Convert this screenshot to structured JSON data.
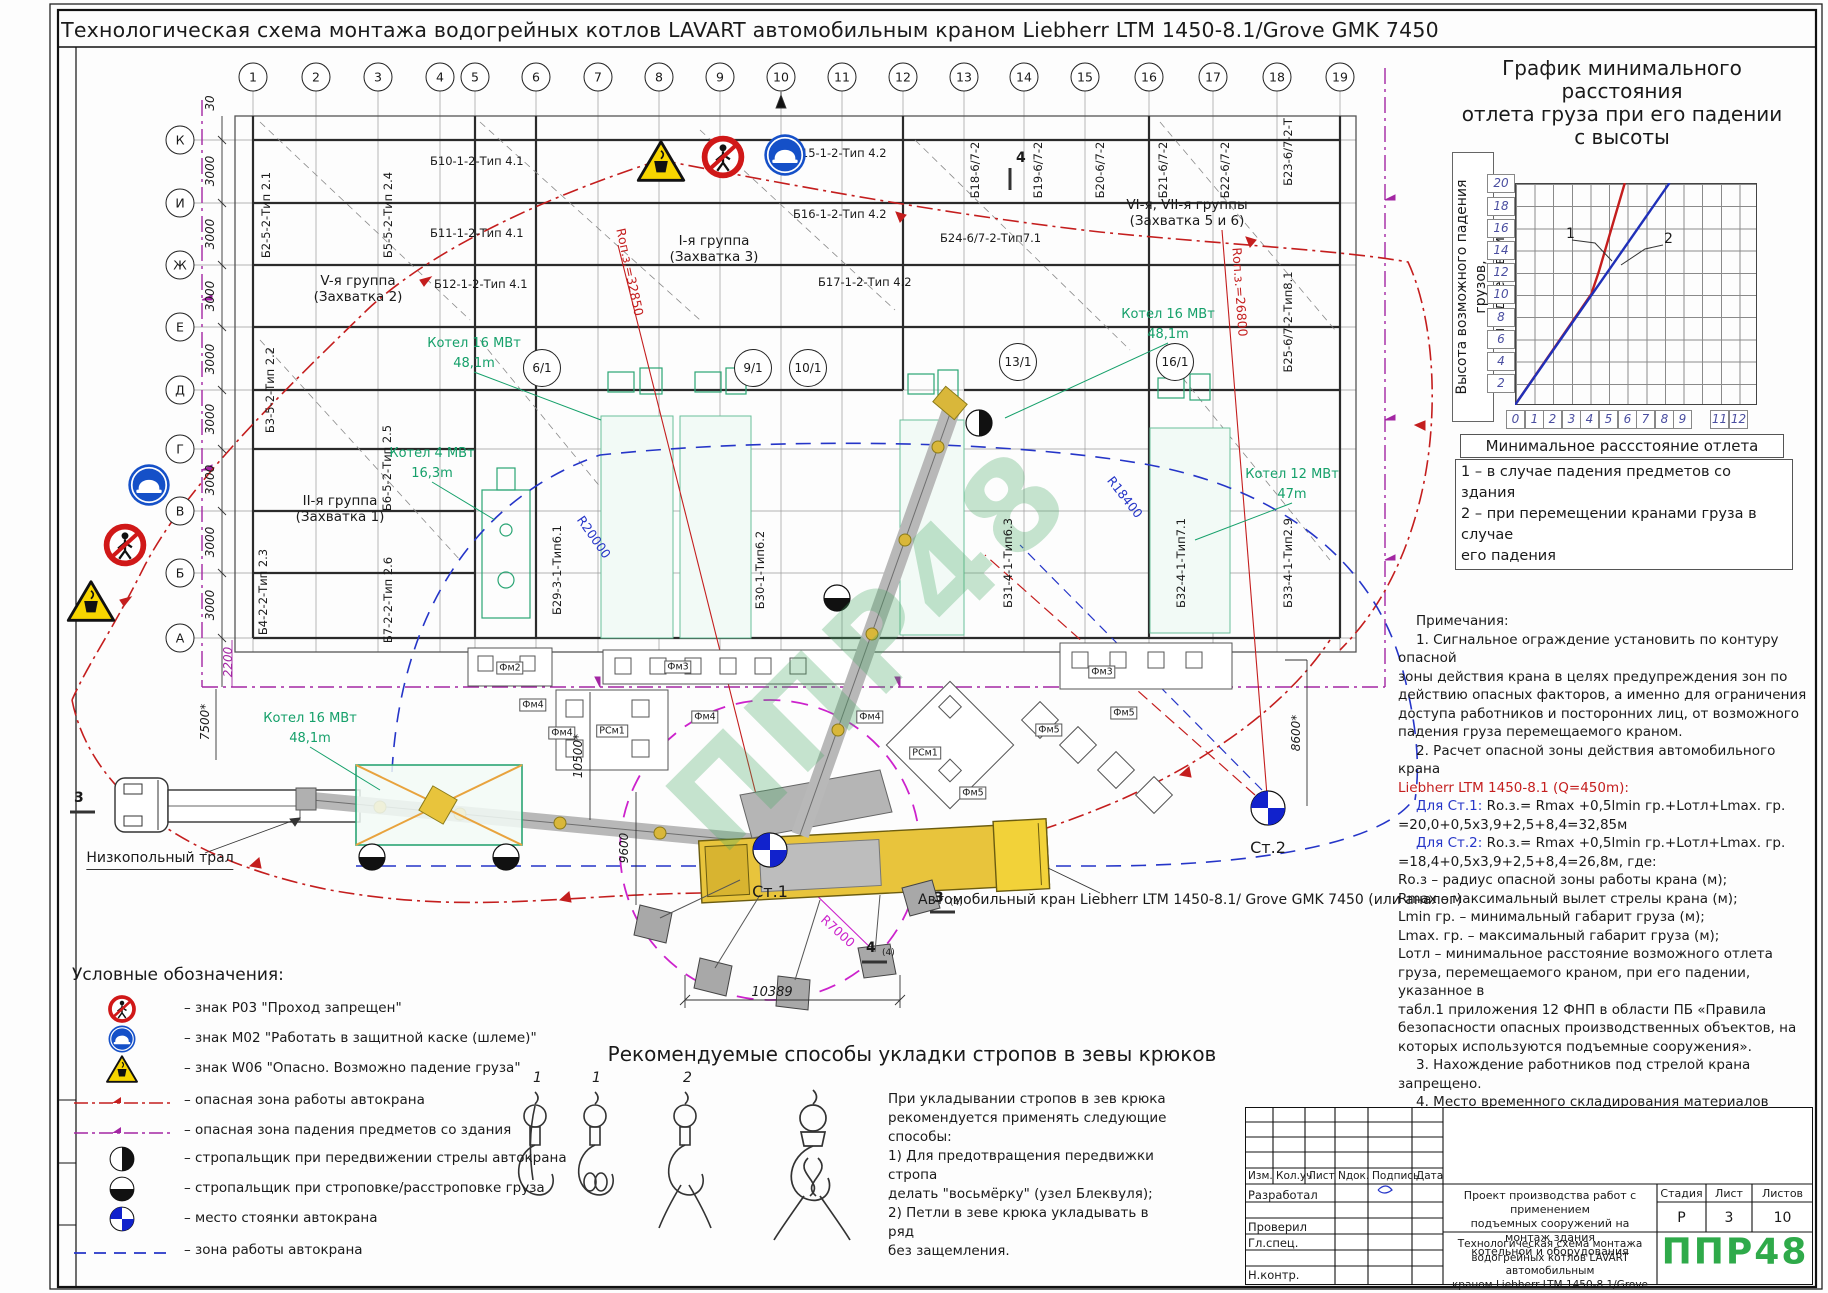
{
  "sheet": {
    "title": "Технологическая схема монтажа водогрейных котлов LAVART автомобильным краном Liebherr LTM 1450-8.1/Grove GMK 7450",
    "watermark": "ППР48"
  },
  "grid": {
    "cols": [
      "1",
      "2",
      "3",
      "4",
      "5",
      "6",
      "7",
      "8",
      "9",
      "10",
      "11",
      "12",
      "13",
      "14",
      "15",
      "16",
      "17",
      "18",
      "19"
    ],
    "rows": [
      "К",
      "И",
      "Ж",
      "Е",
      "Д",
      "Г",
      "В",
      "Б",
      "А"
    ],
    "dim3000": "3000",
    "dim30": "30"
  },
  "plan": {
    "beams": [
      "Б10-1-2-Тип 4.1",
      "Б11-1-2-Тип 4.1",
      "Б12-1-2-Тип 4.1",
      "Б15-1-2-Тип 4.2",
      "Б16-1-2-Тип 4.2",
      "Б17-1-2-Тип 4.2",
      "Б24-6/7-2-Тип7.1",
      "Б2-5-2-Тип 2.1",
      "Б5-5-2-Тип 2.4",
      "Б3-5-2-Тип 2.2",
      "Б6-5-2-Тип 2.5",
      "Б4-2-2-Тип 2.3",
      "Б7-2-2-Тип 2.6",
      "Б18-6/7-2",
      "Б19-6/7-2",
      "Б20-6/7-2",
      "Б21-6/7-2",
      "Б22-6/7-2",
      "Б23-6/7-2-Т",
      "Б25-6/7-2-Тип8.1",
      "Б29-3-1-Тип6.1",
      "Б30-1-Тип6.2",
      "Б31-4-1-Тип6.3",
      "Б32-4-1-Тип7.1",
      "Б33-4-1-Тип2.9"
    ],
    "groups": [
      "V-я группа\n(Захватка 2)",
      "I-я группа\n(Захватка 3)",
      "II-я группа\n(Захватка 1)",
      "VI-я, VII-я группы\n(Захватка 5 и 6)"
    ],
    "kotel": [
      "Котел 16 МВт\n48,1m",
      "Котел 4 МВт\n16,3m",
      "Котел 16 МВт\n48,1m",
      "Котел 12 МВт\n47m",
      "Котел 16 МВт\n48,1m"
    ],
    "radii": [
      "Rоп.з.=32850",
      "Rоп.з.=26800",
      "R20000",
      "R18400",
      "R7000"
    ],
    "sections": [
      "6/1",
      "9/1",
      "10/1",
      "13/1",
      "16/1"
    ],
    "stations": [
      "Ст.1",
      "Ст.2"
    ],
    "fm": [
      "Фм2",
      "Фм3",
      "Фм3",
      "Фм4",
      "Фм4",
      "Фм4",
      "Фм4",
      "Фм5",
      "Фм5",
      "Фм5",
      "РСм1",
      "РСм1"
    ],
    "dims": {
      "d2200": "2200",
      "d7500": "7500*",
      "d10500": "10500*",
      "d9600": "9600",
      "d8600": "8600*",
      "d10389": "10389"
    },
    "cuts": {
      "top": "4",
      "left": "3",
      "r1": "3",
      "r1s": "(4)",
      "r2": "4",
      "r2s": "(4)"
    }
  },
  "machines": {
    "truck": "Низкопольный\nтрал",
    "crane": "Автомобильный кран\nLiebherr LTM 1450-8.1/\nGrove GMK 7450 (или аналог)"
  },
  "chart_data": {
    "type": "line",
    "title": "График минимального\nрасстояния\nотлета груза при его падении\nс высоты",
    "ylabel": "Высота возможного падения грузов,\nпредметов, м",
    "xlabel": "Минимальное рассстояние отлета груза, м",
    "x_ticks": [
      "0",
      "1",
      "2",
      "3",
      "4",
      "5",
      "6",
      "7",
      "8",
      "9",
      "11",
      "12"
    ],
    "y_ticks": [
      "20",
      "18",
      "16",
      "14",
      "12",
      "10",
      "8",
      "6",
      "4",
      "2"
    ],
    "xlim": [
      0,
      13
    ],
    "ylim": [
      0,
      20
    ],
    "grid": true,
    "legend_position": "below",
    "series": [
      {
        "name": "1",
        "color": "#c41e1e",
        "points": [
          [
            0,
            0
          ],
          [
            4.1,
            10
          ],
          [
            4.5,
            12
          ],
          [
            5.9,
            20
          ]
        ]
      },
      {
        "name": "2",
        "color": "#2030b8",
        "points": [
          [
            0,
            0
          ],
          [
            8.3,
            20
          ]
        ]
      }
    ],
    "legend": "1 – в случае падения предметов со здания\n2 – при перемещении кранами груза в случае\nего падения"
  },
  "notes": {
    "head": "Примечания:",
    "p1": "1. Сигнальное ограждение установить по контуру опасной\nзоны действия крана в целях предупреждения зон по\nдействию опасных факторов, а именно для ограничения\nдоступа работников и посторонних лиц, от возможного\nпадения груза перемещаемого краном.",
    "p2": "2. Расчет опасной зоны действия автомобильного крана",
    "p2red": "Liebherr LTM 1450-8.1 (Q=450m):",
    "st1l": "Для Ст.1:",
    "st1f": " Rо.з.= Rmax +0,5lmin гр.+Lотл+Lmax. гр.",
    "st1r": "=20,0+0,5x3,9+2,5+8,4=32,85м",
    "st2l": "Для Ст.2:",
    "st2f": " Rо.з.= Rmax +0,5lmin гр.+Lотл+Lmax. гр.",
    "st2r": "=18,4+0,5x3,9+2,5+8,4=26,8м, где:",
    "defs": "Rо.з – радиус опасной зоны работы крана (м);\nRmax – максимальный вылет стрелы крана (м);\nLmin гр. – минимальный габарит груза (м);\nLmax. гр. – максимальный габарит груза (м);\nLотл – минимальное расстояние возможного отлета\nгруза, перемещаемого краном, при его падении, указанное в\nтабл.1 приложения 12 ФНП в области ПБ «Правила\nбезопасности опасных производственных объектов, на\nкоторых используются подъемные сооружения».",
    "p3": "3. Нахождение работников под стрелой крана\nзапрещено.",
    "p4": "4. Место временного складирования материалов\nуточнить по месту и согласовать с заказчиком.",
    "p5": "5. Размеры со знаком \"*\" уточнить по месту\nпроизводства работ."
  },
  "hooks": {
    "heading": "Рекомендуемые способы укладки стропов в зевы крюков",
    "nums": [
      "1",
      "1",
      "2"
    ],
    "note": "При укладывании стропов в зев крюка\nрекомендуется применять следующие\nспособы:\n1) Для предотвращения передвижки стропа\nделать \"восьмёрку\" (узел Блеквуля);\n2) Петли в зеве крюка укладывать в ряд\nбез защемления."
  },
  "legend": {
    "title": "Условные обозначения:",
    "items": [
      "– знак Р03 \"Проход запрещен\"",
      "– знак М02 \"Работать в защитной каске (шлеме)\"",
      "– знак W06 \"Опасно. Возможно падение груза\"",
      "– опасная зона работы автокрана",
      "– опасная зона падения предметов со здания",
      "– стропальщик при передвижении стрелы автокрана",
      "– стропальщик при строповке/расстроповке груза",
      "– место стоянки автокрана",
      "– зона работы автокрана"
    ]
  },
  "titleblock": {
    "rev_headers": [
      "Изм.",
      "Кол.уч",
      "Лист",
      "Nдок.",
      "Подпись",
      "Дата"
    ],
    "roles": [
      "Разработал",
      "Проверил",
      "Гл.спец.",
      "Н.контр."
    ],
    "project": "Проект производства работ с применением\nподъемных сооружений на монтаж здания\nкотельной и оборудования",
    "doc": "Технологическая схема монтажа\nводогрейных котлов LAVART автомобильным\nкраном Liebherr LTM 1450-8.1/Grove GMK 7450",
    "stage_h": "Стадия",
    "sheet_h": "Лист",
    "sheets_h": "Листов",
    "stage": "Р",
    "sheet": "3",
    "sheets": "10",
    "logo": "ППР48"
  }
}
